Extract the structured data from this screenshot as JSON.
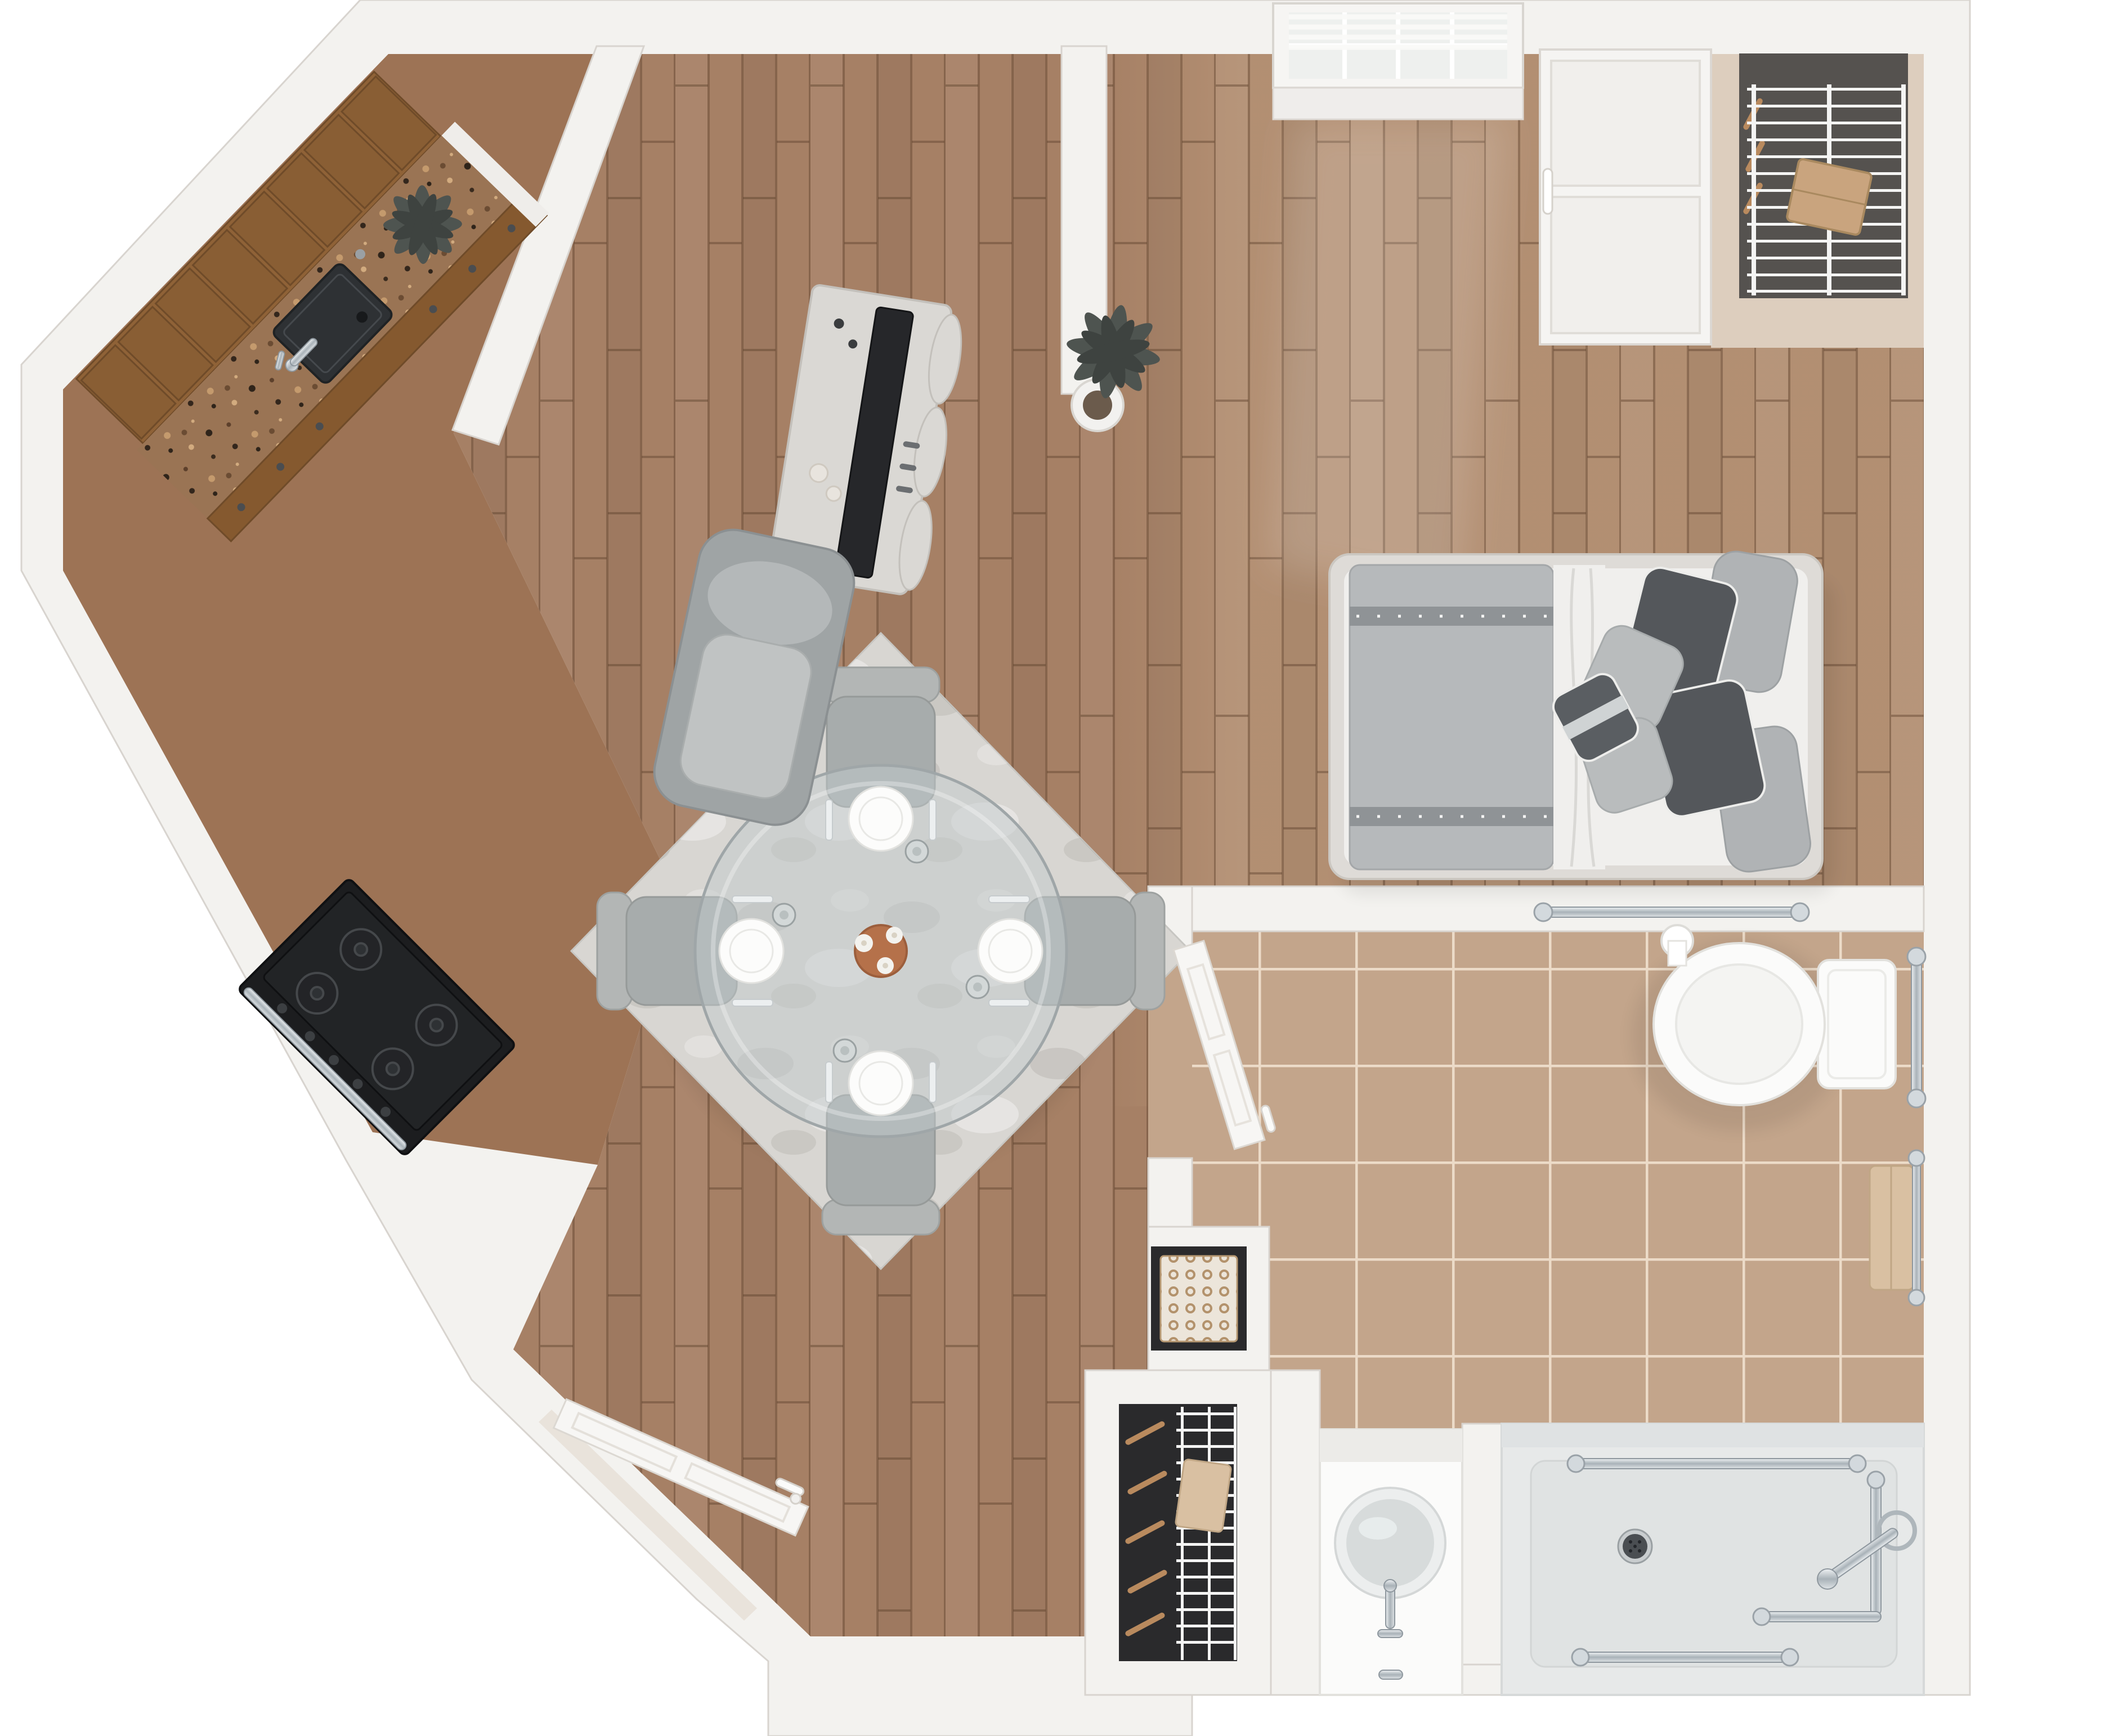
{
  "title": "3D top-down floor plan of a studio apartment",
  "colors": {
    "background": "#ffffff",
    "wall": "#f3f2ef",
    "wall_edge": "#d8d4cf",
    "kitchen_floor": "#9d7355",
    "living_floor": "#a68065",
    "bedroom_floor": "#c2a183",
    "bathroom_tile": "#c3a58b",
    "granite": "#9a7454",
    "cabinet_wood": "#8f6237",
    "cabinet_wood_dark": "#6f4b29",
    "rug": "#d8d6d2",
    "glass_table": "#c2cacc",
    "fixture_white": "#fbfbfa",
    "shower_pan": "#e7e9e9",
    "door_white": "#f7f6f4",
    "window_glass": "#eef0ee",
    "appliance_black": "#1c1d1f",
    "sink_black": "#2e3134",
    "tv_screen": "#26272a",
    "bed_frame": "#dedbd7",
    "duvet_gray": "#b6b9bb",
    "sheet_white": "#f0efed",
    "fabric_gray": "#aab0b1",
    "fabric_charcoal": "#54575b",
    "towel_tan": "#d9c0a2",
    "closet_interior": "#2a2a2c",
    "closet_shadow": "#55524f",
    "wire_shelf": "#f4f4f3",
    "hanger_wood": "#b98a5e",
    "basket_tan": "#c6a98b",
    "plant_green": "#4e5450",
    "vase_terracotta": "#b5714a"
  },
  "floor_plan": {
    "view": "top-down 3D rendering, no text labels",
    "rooms": [
      {
        "name": "kitchen",
        "floor": "brown",
        "items": [
          "upper-cabinets",
          "granite-counter",
          "black-undermount-sink",
          "gooseneck-faucet",
          "soap-pump",
          "counter-plant",
          "range-with-burners"
        ]
      },
      {
        "name": "living-dining",
        "floor": "hardwood-planks",
        "items": [
          "tv-console",
          "flat-screen-tv",
          "decor-candles",
          "accent-chair",
          "area-rug",
          "round-glass-dining-table",
          "dining-chair-x4",
          "place-setting-x4",
          "flower-vase"
        ]
      },
      {
        "name": "bedroom",
        "floor": "hardwood-planks",
        "items": [
          "window-with-blinds",
          "built-in-wardrobe",
          "floor-plant",
          "bed",
          "gray-duvet",
          "white-sheet",
          "pillows"
        ]
      },
      {
        "name": "corner-closet",
        "items": [
          "wire-shelf",
          "storage-box",
          "hangers"
        ]
      },
      {
        "name": "bathroom",
        "floor": "beige-tile",
        "items": [
          "open-door",
          "toilet",
          "grab-bar-horizontal",
          "grab-bar-vertical",
          "toilet-paper-roll",
          "towel-bar-with-towel",
          "vanity-with-round-basin",
          "half-wall",
          "roll-in-shower",
          "shower-drain",
          "shower-grab-bars",
          "shower-control"
        ]
      },
      {
        "name": "walk-in-closet",
        "items": [
          "wire-shelving",
          "hangers",
          "folded-towel"
        ]
      },
      {
        "name": "linen-niche",
        "items": [
          "patterned-basket"
        ]
      },
      {
        "name": "entry",
        "items": [
          "open-entry-door",
          "lever-handle",
          "threshold"
        ]
      }
    ]
  }
}
